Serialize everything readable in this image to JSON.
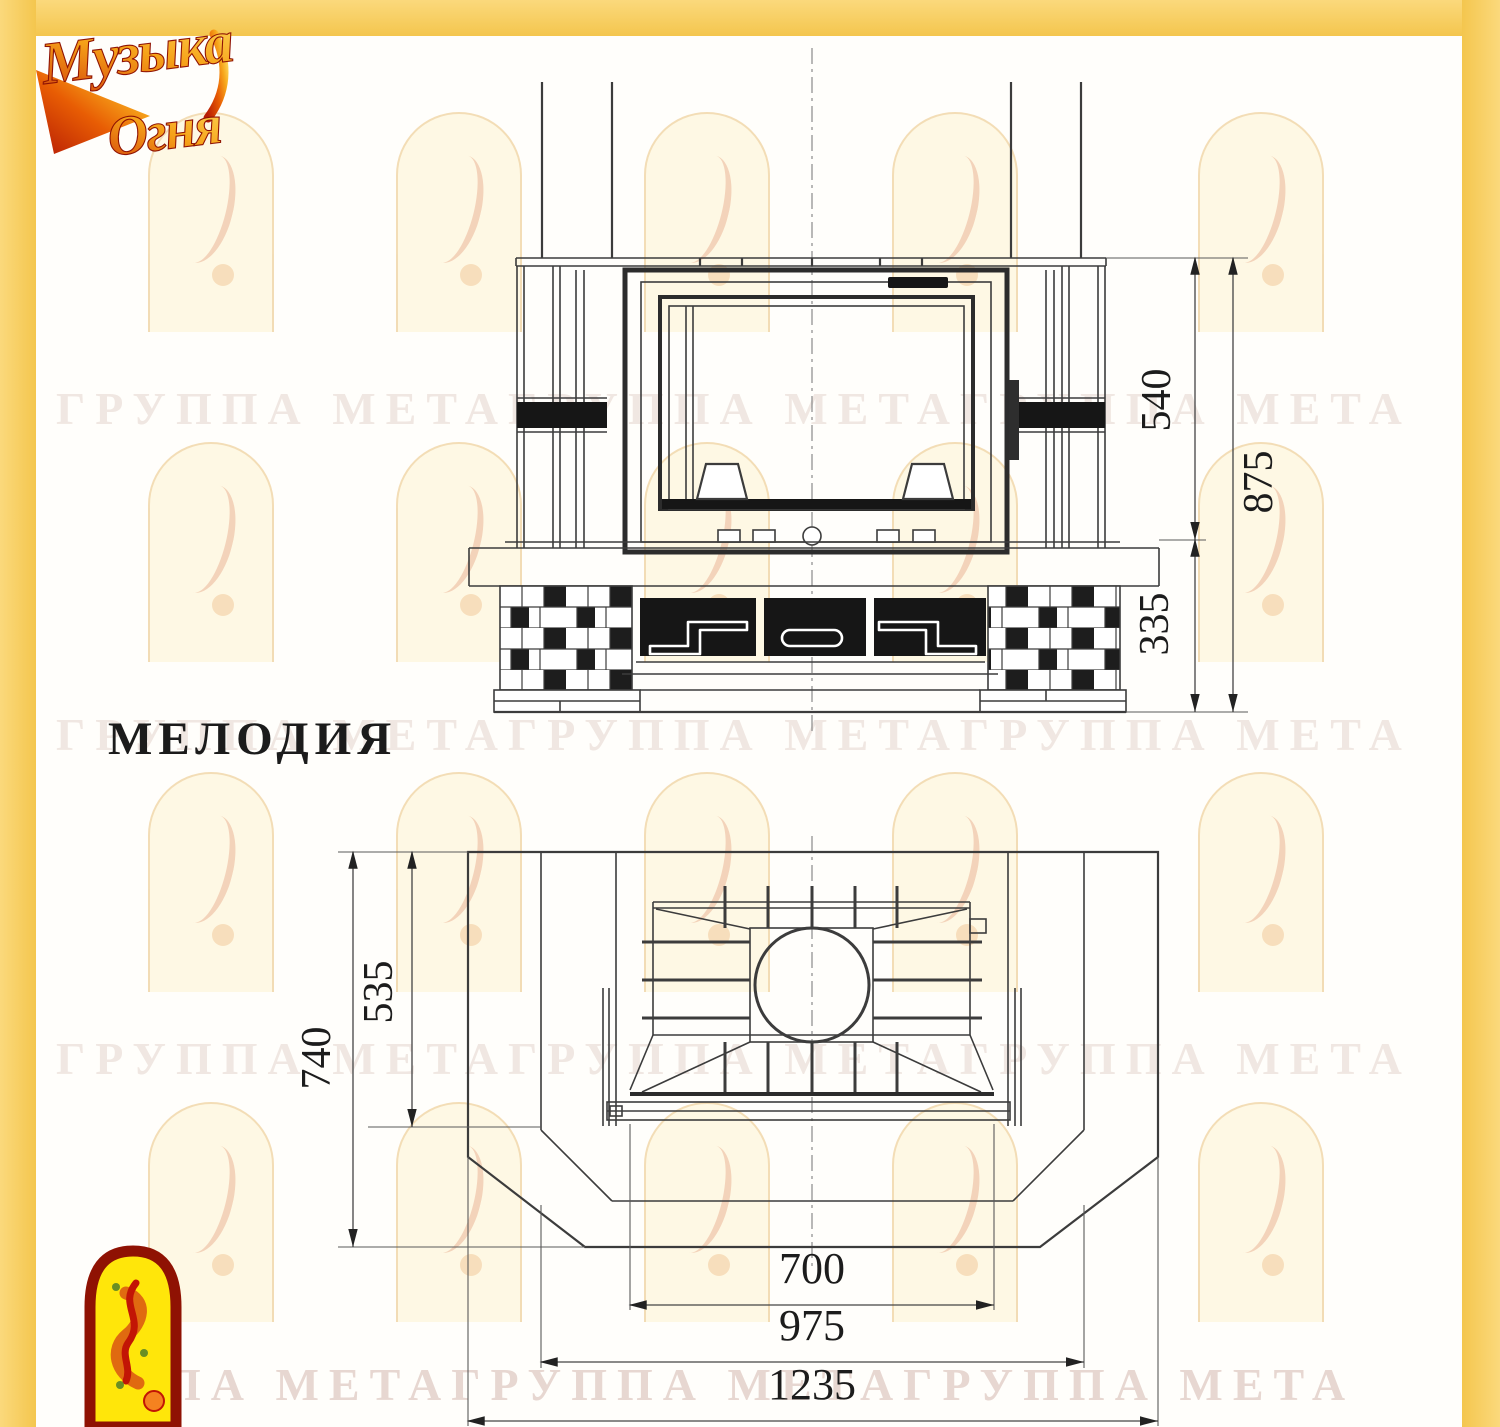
{
  "brand": {
    "logo_line1": "Музыка",
    "logo_line2": "Огня"
  },
  "title": "МЕЛОДИЯ",
  "watermark": {
    "rows": [
      "ГРУППА МЕТАГРУППА МЕТАГРУППА МЕТА",
      "ГРУППА МЕТАГРУППА МЕТАГРУППА МЕТА",
      "ГРУППА МЕТАГРУППА МЕТАГРУППА МЕТА",
      "ПА МЕТАГРУППА МЕТАГРУППА МЕТА"
    ]
  },
  "front_view": {
    "dim_540": "540",
    "dim_875": "875",
    "dim_335": "335"
  },
  "plan_view": {
    "dim_740": "740",
    "dim_535": "535",
    "dim_700": "700",
    "dim_975": "975",
    "dim_1235": "1235"
  },
  "colors": {
    "frame_yellow": "#F7CD5C",
    "line": "#3C3C3C",
    "accent_red": "#B91605",
    "accent_orange": "#F07818",
    "emblem_yellow": "#FFE60A"
  }
}
